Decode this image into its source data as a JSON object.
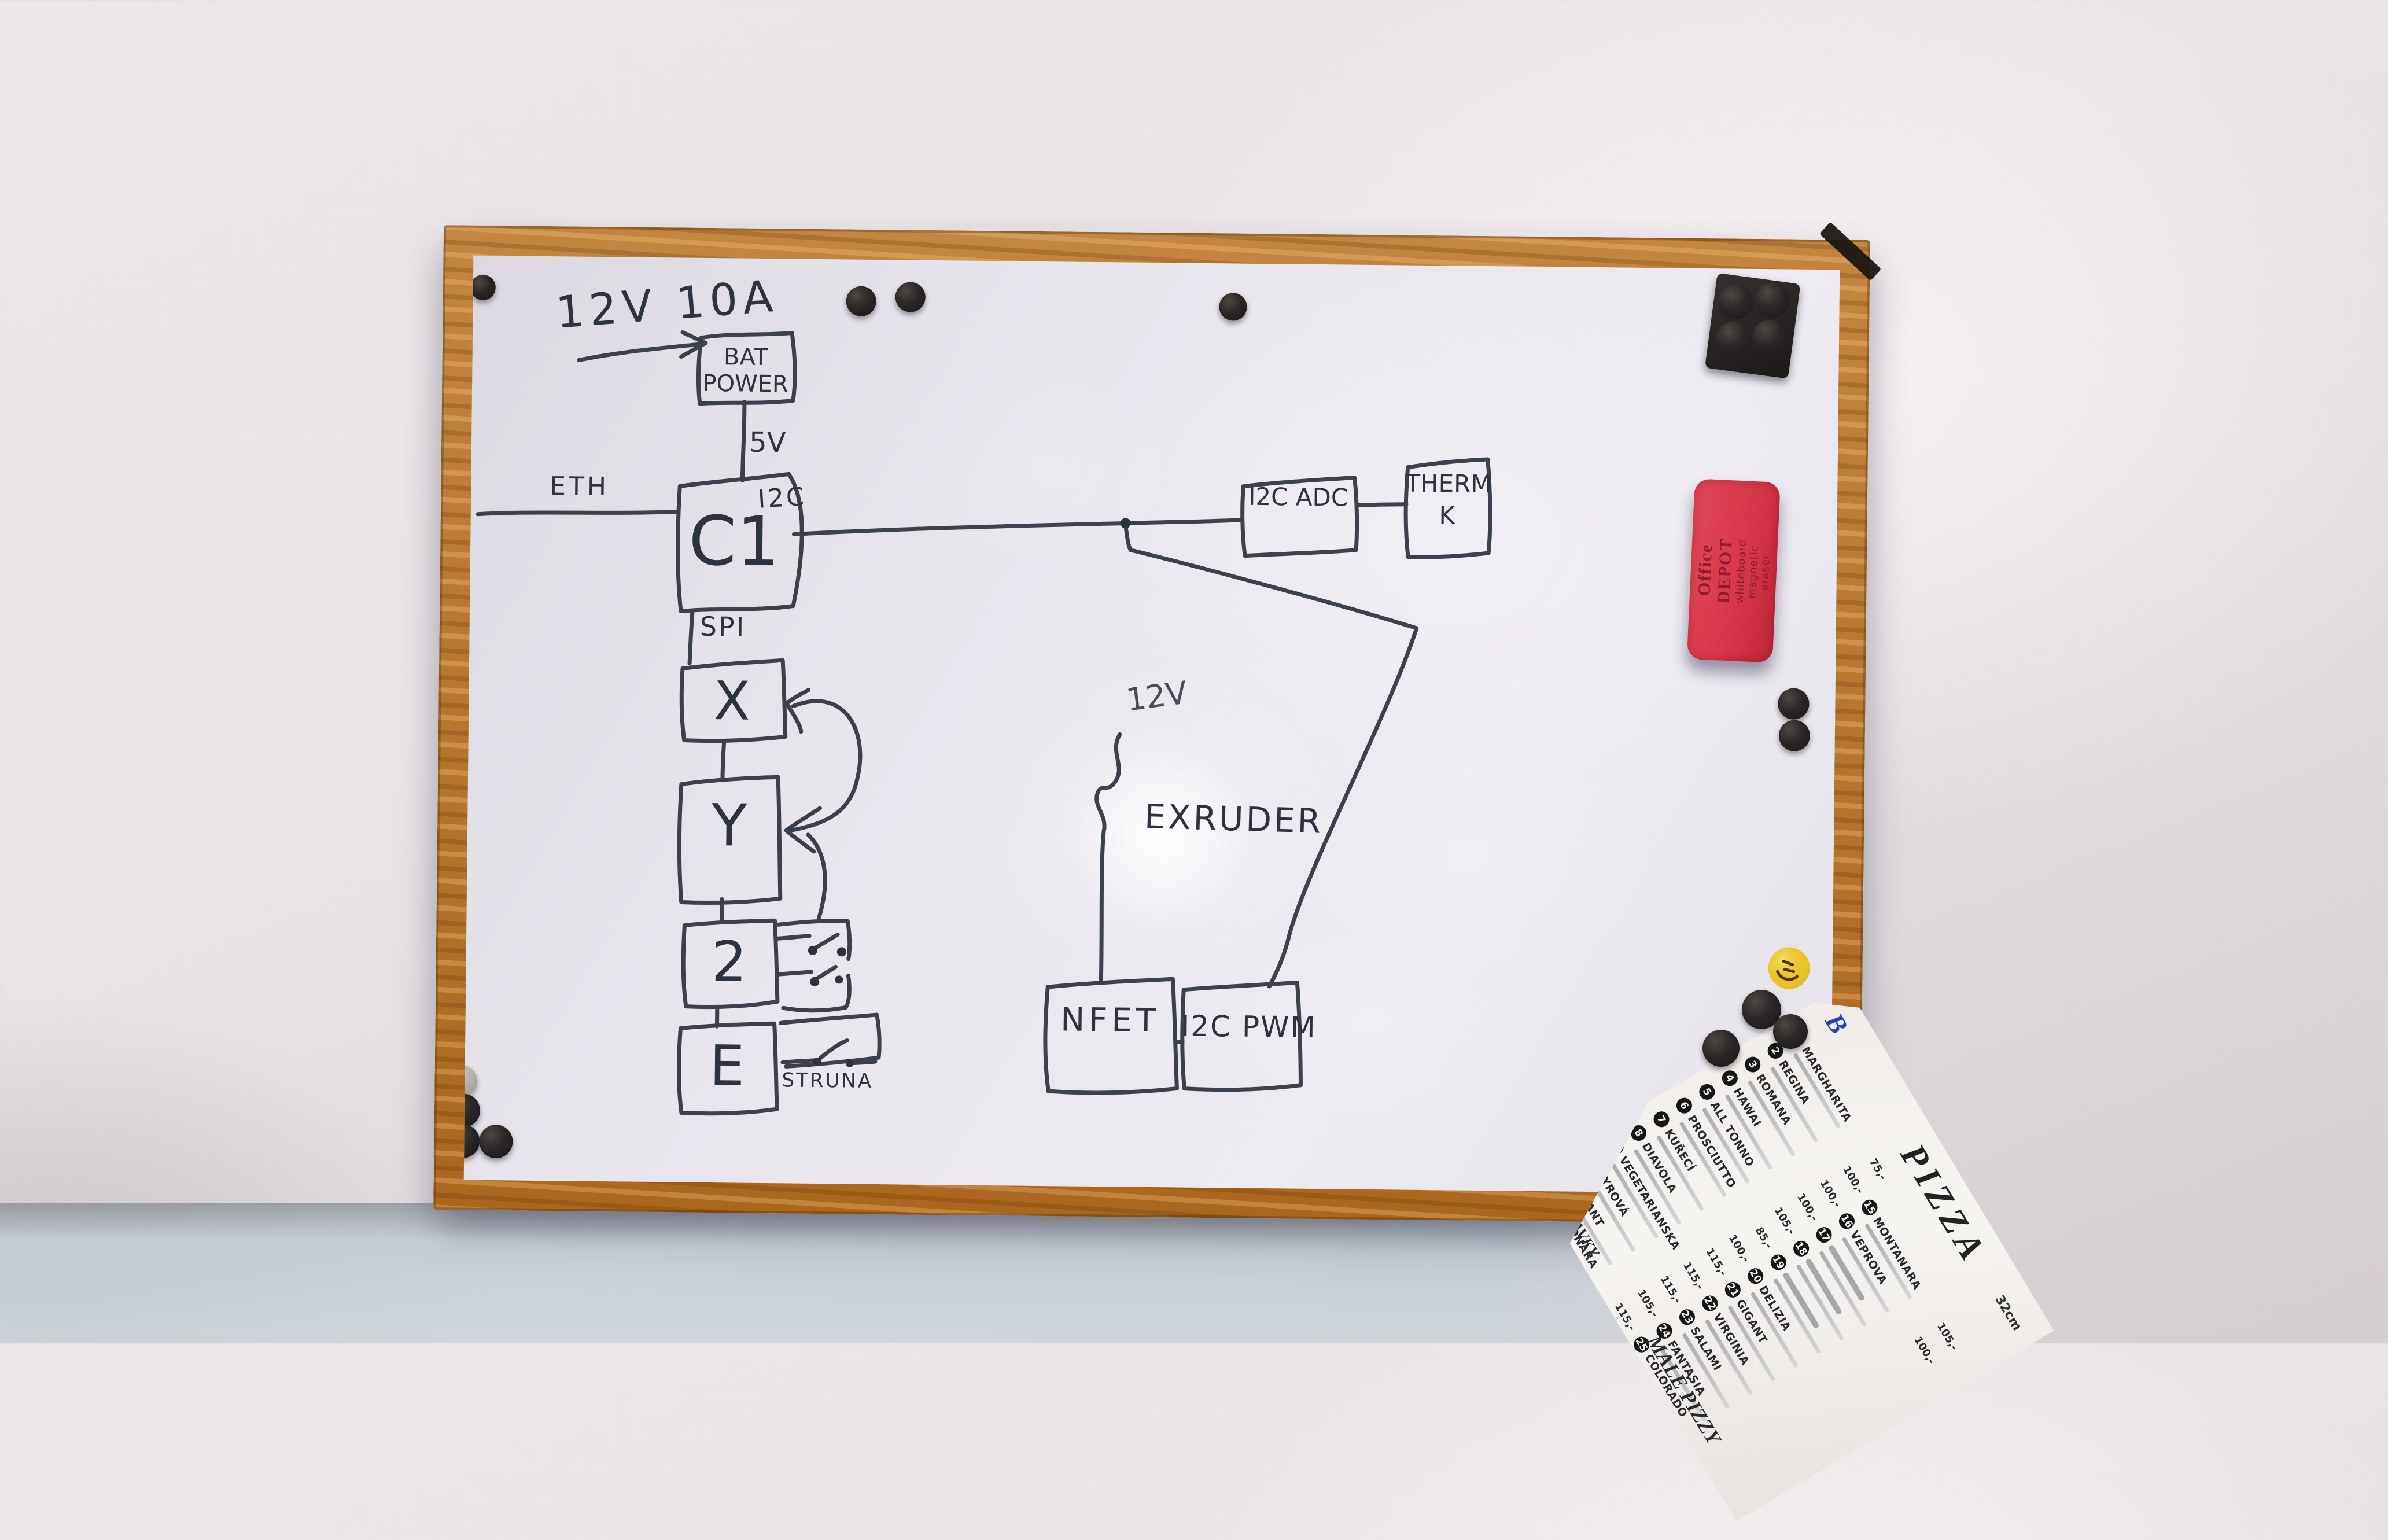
{
  "colors": {
    "marker": "#2d333f",
    "wood": "#b3742f",
    "eraser_red": "#d63748",
    "smiley_yellow": "#e9c428",
    "wall": "#eae4e7",
    "whiteboard": "#e8e5ed"
  },
  "board": {
    "note": "12V 10A",
    "labels": {
      "eth": "ETH",
      "v5": "5V",
      "i2c": "I2C",
      "spi": "SPI",
      "v12": "12V",
      "extruder": "EXRUDER",
      "struna": "STRUNA"
    },
    "boxes": {
      "bat_power": [
        "BAT",
        "POWER"
      ],
      "controller": "C1",
      "i2c_adc": "I2C ADC",
      "therm": [
        "THERM",
        "K"
      ],
      "axis_x": "X",
      "axis_y": "Y",
      "axis_z": "2",
      "axis_e": "E",
      "nfet": "NFET",
      "i2c_pwm": "I2C PWM"
    }
  },
  "eraser": {
    "line1": "Office DEPOT",
    "line2": "whiteboard magnetic eraser"
  },
  "menu": {
    "title": "PIZZA",
    "size_note": "32cm",
    "logo": "B",
    "sections": [
      "MALÉ PIZZY",
      "PŘIDAVKY"
    ],
    "col1": [
      {
        "num": "1",
        "name": "MARGHARITA",
        "price": "75,-"
      },
      {
        "num": "2",
        "name": "REGINA",
        "price": "100,-"
      },
      {
        "num": "3",
        "name": "ROMANA",
        "price": "100,-"
      },
      {
        "num": "4",
        "name": "HAWAI",
        "price": "100,-"
      },
      {
        "num": "5",
        "name": "ALL TONNO",
        "price": "105,-"
      },
      {
        "num": "6",
        "name": "PROSCIUTTO",
        "price": "85,-"
      },
      {
        "num": "7",
        "name": "KUŘECÍ",
        "price": "100,-"
      },
      {
        "num": "8",
        "name": "DIAVOLA",
        "price": "115,-"
      },
      {
        "num": "9",
        "name": "VEGETARIANSKA",
        "price": "115,-"
      },
      {
        "num": "10",
        "name": "SYROVÁ",
        "price": "115,-"
      },
      {
        "num": "11",
        "name": "PIKANT",
        "price": "105,-"
      },
      {
        "num": "12",
        "name": "CARBONARA",
        "price": "115,-"
      },
      {
        "num": "13",
        "name": "COLOSEUM",
        "price": "100,-"
      }
    ],
    "col2": [
      {
        "num": "15",
        "name": "MONTANARA",
        "price": "105,-"
      },
      {
        "num": "16",
        "name": "VEPROVA",
        "price": "100,-"
      },
      {
        "num": "17",
        "name": "",
        "price": ""
      },
      {
        "num": "18",
        "name": "",
        "price": ""
      },
      {
        "num": "19",
        "name": "",
        "price": ""
      },
      {
        "num": "20",
        "name": "DELIZIA",
        "price": ""
      },
      {
        "num": "21",
        "name": "GIGANT",
        "price": ""
      },
      {
        "num": "22",
        "name": "VIRGINIA",
        "price": ""
      },
      {
        "num": "23",
        "name": "SALAMI",
        "price": ""
      },
      {
        "num": "24",
        "name": "FANTASIA",
        "price": ""
      },
      {
        "num": "25",
        "name": "COLORADO",
        "price": ""
      }
    ]
  }
}
